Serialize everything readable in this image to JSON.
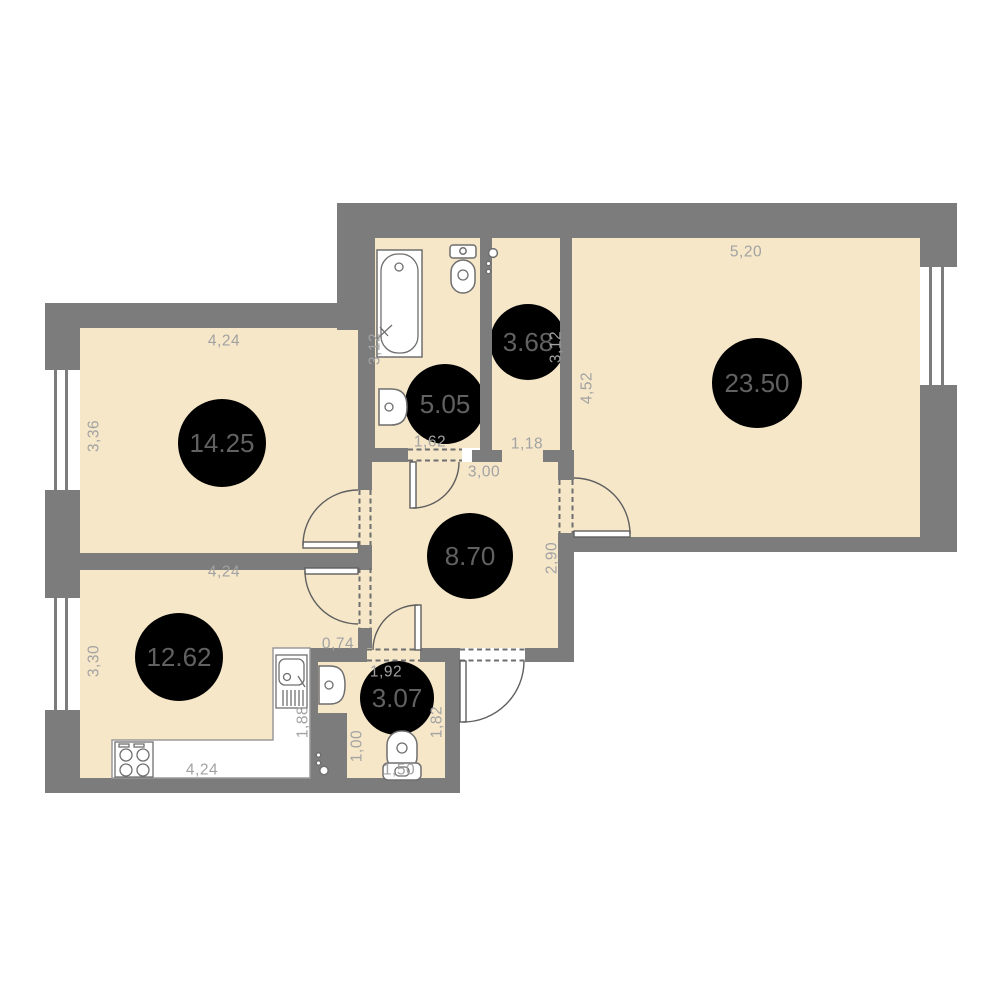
{
  "page": {
    "type": "apartment-floor-plan",
    "background": "#ffffff"
  },
  "colors": {
    "wall": "#7c7c7c",
    "floor": "#f6e7c9",
    "dimension_text": "#a2a2a2",
    "area_text": "#616161",
    "fixture_line": "#6f6f6f"
  },
  "rooms": [
    {
      "id": "room-14-25",
      "area": "14.25"
    },
    {
      "id": "bathroom-5-05",
      "area": "5.05"
    },
    {
      "id": "room-3-68",
      "area": "3.68"
    },
    {
      "id": "room-23-50",
      "area": "23.50"
    },
    {
      "id": "hall-8-70",
      "area": "8.70"
    },
    {
      "id": "kitchen-12-62",
      "area": "12.62"
    },
    {
      "id": "wc-3-07",
      "area": "3.07"
    }
  ],
  "dims": {
    "r1425_top": "4,24",
    "r1425_left": "3,36",
    "bath_left": "3,12",
    "bath_bottom": "1,62",
    "r368_bottom": "1,18",
    "r368_right": "3,12",
    "r2350_top": "5,20",
    "r2350_left": "4,52",
    "hall_top": "3,00",
    "hall_right": "2,90",
    "r1262_top": "4,24",
    "r1262_left": "3,30",
    "wall_segment": "0,74",
    "counter_bottom": "4,24",
    "counter_right": "1,88",
    "wc_top": "1,92",
    "wc_right": "1,82",
    "wc_left": "1,00",
    "wc_bottom": "1,50"
  },
  "fixtures": [
    "bathtub",
    "toilet",
    "wash-basin",
    "kitchen-counter",
    "stove",
    "kitchen-sink",
    "vent-stack",
    "window",
    "door"
  ]
}
